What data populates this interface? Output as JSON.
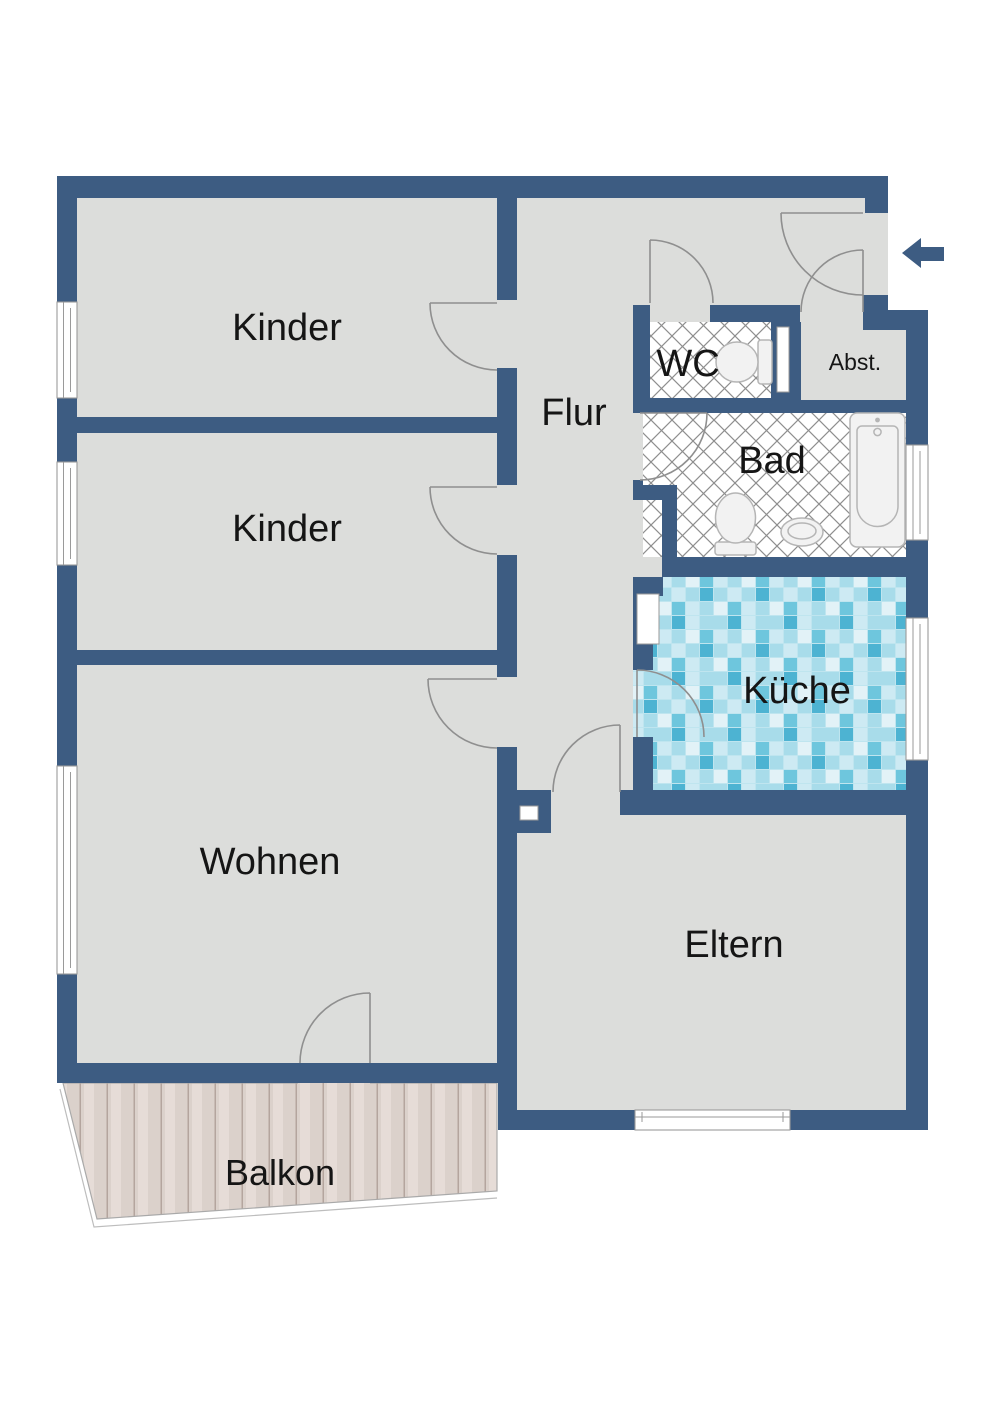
{
  "plan": {
    "kind": "apartment-floor-plan",
    "rooms": {
      "kinder1": {
        "label": "Kinder"
      },
      "kinder2": {
        "label": "Kinder"
      },
      "wohnen": {
        "label": "Wohnen"
      },
      "flur": {
        "label": "Flur"
      },
      "wc": {
        "label": "WC"
      },
      "abst": {
        "label": "Abst."
      },
      "bad": {
        "label": "Bad"
      },
      "kueche": {
        "label": "Küche"
      },
      "eltern": {
        "label": "Eltern"
      },
      "balkon": {
        "label": "Balkon"
      }
    },
    "fixtures": [
      "bathtub",
      "toilet-in-wc",
      "toilet-in-bad",
      "washbasin"
    ],
    "icons": {
      "entrance_arrow": "left-arrow"
    }
  },
  "colors": {
    "wall_color": "#3d5c82",
    "floor_color": "#dcdddb",
    "label_color": "#151515",
    "door_stroke": "#8f8f8f",
    "window_frame": "#9a9a9a",
    "fixture_fill": "#f2f2f2",
    "fixture_stroke": "#b5b5b5",
    "tile_line": "#8e8e8e",
    "balcony_outline": "#a9a9a9",
    "mosaic_palette_1": "#4db3d2",
    "mosaic_palette_2": "#6ec6dd",
    "mosaic_palette_3": "#a8dcea",
    "mosaic_palette_4": "#cdeaf3",
    "mosaic_palette_5": "#e2f2f7",
    "wood_base": "#dbd1cb",
    "wood_line": "#b4a59e"
  }
}
